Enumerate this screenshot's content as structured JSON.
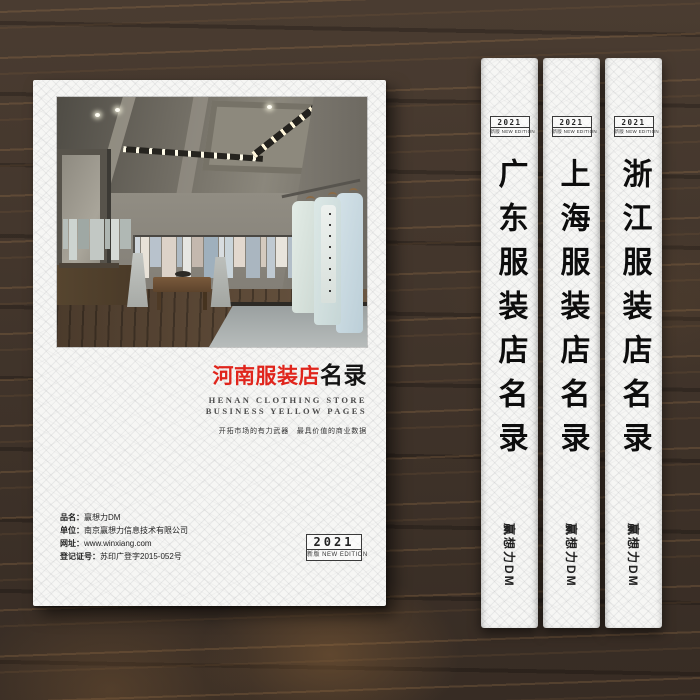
{
  "cover": {
    "title_red": "河南服装店",
    "title_black": "名录",
    "subtitle_line1": "HENAN CLOTHING STORE",
    "subtitle_line2": "BUSINESS YELLOW PAGES",
    "tagline": "开拓市场的有力武器　最具价值的商业数据",
    "info_lines": [
      {
        "label": "品名：",
        "value": "赢想力DM"
      },
      {
        "label": "单位：",
        "value": "南京赢想力信息技术有限公司"
      },
      {
        "label": "网址：",
        "value": "www.winxiang.com"
      },
      {
        "label": "登记证号：",
        "value": "苏印广登字2015-052号"
      }
    ],
    "badge": {
      "year": "2021",
      "edition": "新版 NEW EDITION"
    }
  },
  "spines": [
    {
      "year": "2021",
      "edition": "新版 NEW EDITION",
      "title": "广东服装店名录",
      "brand": "赢想力DM"
    },
    {
      "year": "2021",
      "edition": "新版 NEW EDITION",
      "title": "上海服装店名录",
      "brand": "赢想力DM"
    },
    {
      "year": "2021",
      "edition": "新版 NEW EDITION",
      "title": "浙江服装店名录",
      "brand": "赢想力DM"
    }
  ],
  "colors": {
    "accent_red": "#e0251c",
    "cover_white": "#f6f6f4",
    "wood_dark": "#3f332a"
  },
  "photo": {
    "description": "clothing boutique interior with racks of pastel garments",
    "left_rack_colors": [
      "#b6beba",
      "#cdd4d0",
      "#9fa8a4",
      "#c2c8c4",
      "#aeb6b2",
      "#d6dad6",
      "#b0b8b4"
    ],
    "center_rack_colors": [
      "#cfd6dc",
      "#e8e2d8",
      "#b8c2cc",
      "#dcd2c8",
      "#aebac4",
      "#e6e6e2",
      "#c4b8ae",
      "#9fb0bd",
      "#d8dde0",
      "#c9d4da",
      "#e2d8ce",
      "#aab6c0",
      "#d4cabe",
      "#bfc9d1",
      "#e8e4dc",
      "#b2bec8",
      "#d0d8dc",
      "#c6baae"
    ]
  }
}
